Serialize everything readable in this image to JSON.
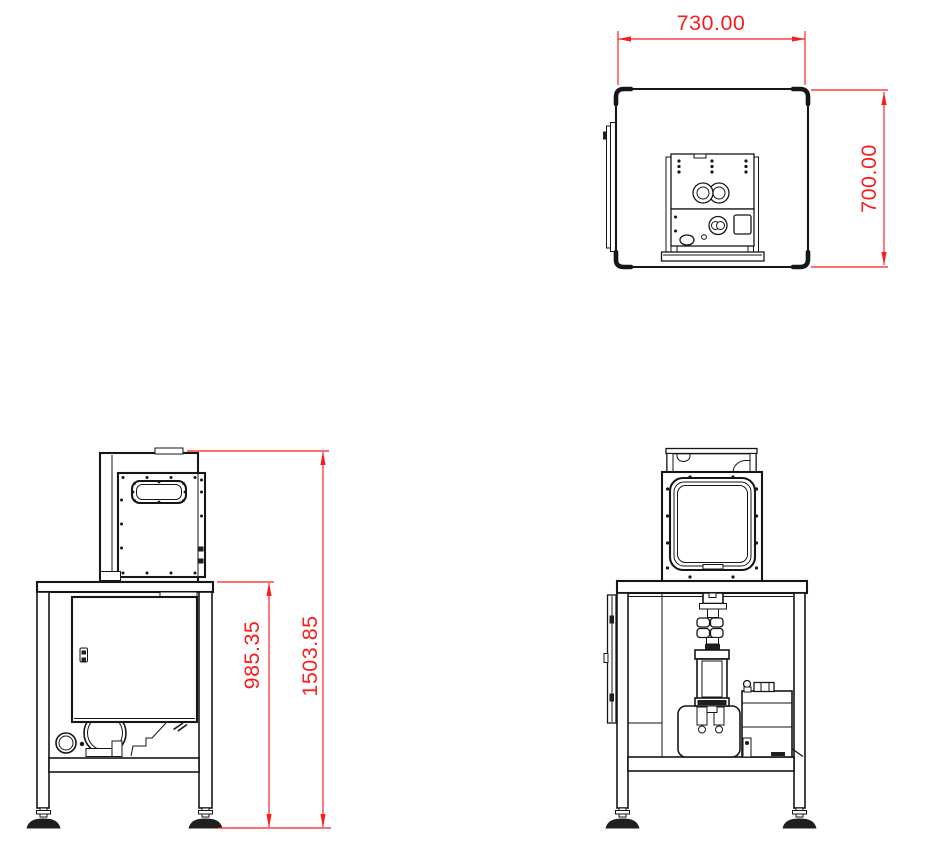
{
  "drawing": {
    "type": "engineering-3-view-drawing",
    "views": {
      "top": {
        "label": "top view"
      },
      "front": {
        "label": "front view"
      },
      "side": {
        "label": "side view"
      }
    }
  },
  "colors": {
    "background": "#ffffff",
    "line": "#161616",
    "dimension": "#fb1d1d"
  },
  "dimensions": {
    "width": "730.00",
    "depth": "700.00",
    "table_height": "985.35",
    "overall_height": "1503.85"
  }
}
